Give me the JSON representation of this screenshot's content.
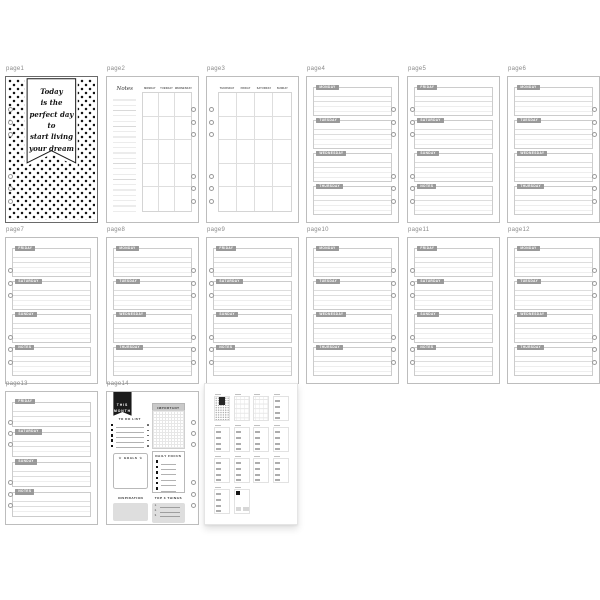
{
  "colors": {
    "background": "#ffffff",
    "page_border": "#bdbdbd",
    "label_text": "#8a8a8a",
    "day_tab_bg": "#9a9a9a",
    "day_tab_text": "#ffffff",
    "rule_line": "#dddddd",
    "polka_dot": "#151515",
    "banner_bg": "#ffffff",
    "banner_border": "#1a1a1a",
    "dashboard_banner_bg": "#1a1a1a",
    "gray_fill": "#dedede"
  },
  "pages": [
    {
      "id": "page1",
      "label": "page1",
      "type": "cover",
      "holes": "left",
      "banner_lines": [
        "Today",
        "is the",
        "perfect day",
        "to",
        "start living",
        "your dream"
      ]
    },
    {
      "id": "page2",
      "label": "page2",
      "type": "month-left",
      "holes": "right",
      "notes_header": "Notes",
      "day_headers": [
        "MONDAY",
        "TUESDAY",
        "WEDNESDAY"
      ],
      "grid_rows": 5
    },
    {
      "id": "page3",
      "label": "page3",
      "type": "month-right",
      "holes": "left",
      "day_headers": [
        "THURSDAY",
        "FRIDAY",
        "SATURDAY",
        "SUNDAY"
      ],
      "grid_rows": 5
    },
    {
      "id": "page4",
      "label": "page4",
      "type": "week",
      "holes": "right",
      "sections": [
        "MONDAY",
        "TUESDAY",
        "WEDNESDAY",
        "THURSDAY"
      ]
    },
    {
      "id": "page5",
      "label": "page5",
      "type": "week",
      "holes": "left",
      "sections": [
        "FRIDAY",
        "SATURDAY",
        "SUNDAY",
        "NOTES"
      ]
    },
    {
      "id": "page6",
      "label": "page6",
      "type": "week",
      "holes": "right",
      "sections": [
        "MONDAY",
        "TUESDAY",
        "WEDNESDAY",
        "THURSDAY"
      ]
    },
    {
      "id": "page7",
      "label": "page7",
      "type": "week",
      "holes": "left",
      "sections": [
        "FRIDAY",
        "SATURDAY",
        "SUNDAY",
        "NOTES"
      ]
    },
    {
      "id": "page8",
      "label": "page8",
      "type": "week",
      "holes": "right",
      "sections": [
        "MONDAY",
        "TUESDAY",
        "WEDNESDAY",
        "THURSDAY"
      ]
    },
    {
      "id": "page9",
      "label": "page9",
      "type": "week",
      "holes": "left",
      "sections": [
        "FRIDAY",
        "SATURDAY",
        "SUNDAY",
        "NOTES"
      ]
    },
    {
      "id": "page10",
      "label": "page10",
      "type": "week",
      "holes": "right",
      "sections": [
        "MONDAY",
        "TUESDAY",
        "WEDNESDAY",
        "THURSDAY"
      ]
    },
    {
      "id": "page11",
      "label": "page11",
      "type": "week",
      "holes": "left",
      "sections": [
        "FRIDAY",
        "SATURDAY",
        "SUNDAY",
        "NOTES"
      ]
    },
    {
      "id": "page12",
      "label": "page12",
      "type": "week",
      "holes": "right",
      "sections": [
        "MONDAY",
        "TUESDAY",
        "WEDNESDAY",
        "THURSDAY"
      ]
    },
    {
      "id": "page13",
      "label": "page13",
      "type": "week",
      "holes": "left",
      "sections": [
        "FRIDAY",
        "SATURDAY",
        "SUNDAY",
        "NOTES"
      ]
    },
    {
      "id": "page14",
      "label": "page14",
      "type": "dashboard",
      "holes": "right",
      "banner_lines": [
        "THIS",
        "MONTH"
      ],
      "todo": {
        "title": "TO DO LIST",
        "rows": 5
      },
      "important": {
        "title": "IMPORTANT"
      },
      "goals": {
        "title": "GOALS",
        "star": "☆"
      },
      "daily_focus": {
        "title": "DAILY FOCUS",
        "rows": 6
      },
      "inspiration": {
        "title": "INSPIRATION"
      },
      "top3": {
        "title": "TOP 3 THINGS",
        "items": [
          "1.",
          "2.",
          "3."
        ]
      }
    }
  ],
  "overview": {
    "minis": [
      "cover",
      "month-left",
      "month-right",
      "week",
      "week",
      "week",
      "week",
      "week",
      "week",
      "week",
      "week",
      "week",
      "week",
      "dashboard"
    ]
  }
}
